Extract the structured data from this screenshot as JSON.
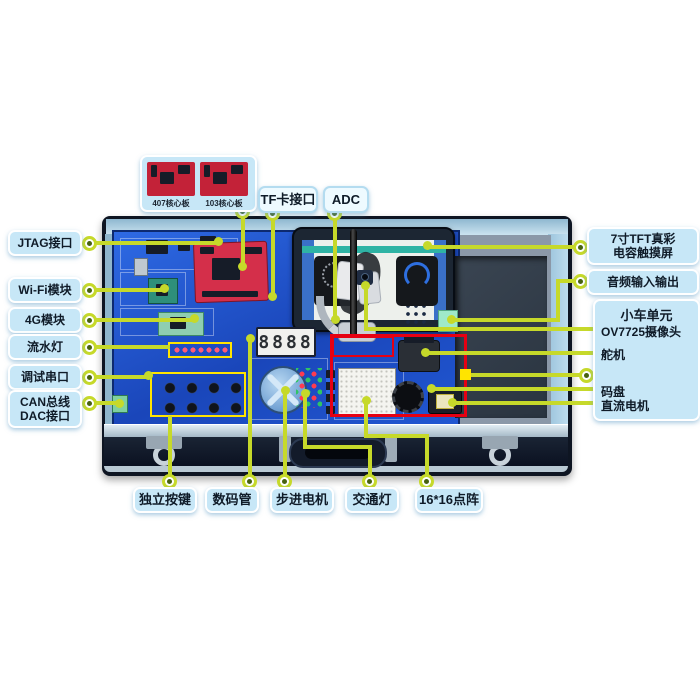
{
  "colors": {
    "line_green": "#c6d92a",
    "marker_yellow": "#ffe400",
    "marker_red": "#e60012",
    "label_fill": "#c7e7f7",
    "label_fill_light": "#eefaff",
    "label_text": "#0f1b28",
    "pcb_blue": "#1f55cf",
    "core_board_red": "#d42f4a",
    "screen_teal": "#2fb3a4",
    "case_dark": "#0e1522",
    "foam_gray": "#8b98a8"
  },
  "top_panel": {
    "core_boards": [
      "407核心板",
      "103核心板"
    ]
  },
  "labels": {
    "tf_card": "TF卡接口",
    "adc": "ADC",
    "jtag": "JTAG接口",
    "wifi": "Wi-Fi模块",
    "g4": "4G模块",
    "flow_led": "流水灯",
    "debug_serial": "调试串口",
    "can_line1": "CAN总线",
    "can_line2": "DAC接口",
    "tft_line1": "7寸TFT真彩",
    "tft_line2": "电容触摸屏",
    "audio": "音频输入输出",
    "car_unit_title": "小车单元",
    "camera": "OV7725摄像头",
    "servo": "舵机",
    "encoder": "码盘",
    "dc_motor": "直流电机",
    "keys": "独立按键",
    "seven_seg": "数码管",
    "stepper": "步进电机",
    "traffic_light": "交通灯",
    "dot_matrix": "16*16点阵"
  },
  "board": {
    "seven_segment_value": "8888"
  }
}
